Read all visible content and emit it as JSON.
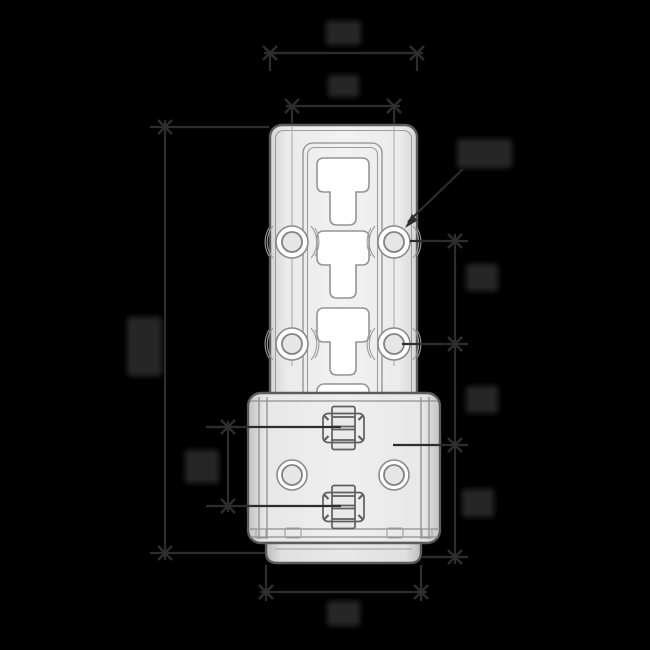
{
  "canvas": {
    "width": 650,
    "height": 650,
    "background": "#000000"
  },
  "drawing": {
    "type": "technical-dimension-drawing",
    "view": "front",
    "part_fill": "#e9e9e9",
    "part_edge_color": "#5c5c5c",
    "detail_line_color": "#8f8f8f",
    "cutout_fill": "#ffffff",
    "features": [
      {
        "id": "upper-plate",
        "desc": "tall mounting plate with rounded corners"
      },
      {
        "id": "recessed-channel",
        "desc": "central recessed channel with double rim"
      },
      {
        "id": "t-slots",
        "count": 4,
        "desc": "T-shaped keyhole cutouts in channel"
      },
      {
        "id": "plate-holes",
        "count": 4,
        "desc": "round bosses with through holes, two rows of two"
      },
      {
        "id": "lower-housing",
        "desc": "wider housing box with side bend lines"
      },
      {
        "id": "clips",
        "count": 2,
        "desc": "center latch clips, vertically spaced"
      },
      {
        "id": "housing-holes",
        "count": 2,
        "desc": "round through holes in housing"
      },
      {
        "id": "base-foot",
        "desc": "rounded base strip under housing"
      }
    ]
  },
  "dims": {
    "line_color": "#2d2d2d",
    "label_color": "#272727",
    "labels_blurred": true,
    "annotations": [
      {
        "id": "top-outer-width",
        "kind": "linear",
        "axis": "horizontal",
        "label": ""
      },
      {
        "id": "hole-column-spacing",
        "kind": "linear",
        "axis": "horizontal",
        "label": ""
      },
      {
        "id": "overall-height",
        "kind": "linear",
        "axis": "vertical",
        "label": ""
      },
      {
        "id": "hole-diameter",
        "kind": "diameter-leader",
        "axis": "leader",
        "label": ""
      },
      {
        "id": "hole-row-pitch",
        "kind": "linear",
        "axis": "vertical",
        "label": ""
      },
      {
        "id": "row-to-housing",
        "kind": "linear",
        "axis": "vertical",
        "label": ""
      },
      {
        "id": "housing-to-base",
        "kind": "linear",
        "axis": "vertical",
        "label": ""
      },
      {
        "id": "clip-spacing",
        "kind": "linear",
        "axis": "vertical",
        "label": ""
      },
      {
        "id": "base-width",
        "kind": "linear",
        "axis": "horizontal",
        "label": ""
      }
    ]
  }
}
